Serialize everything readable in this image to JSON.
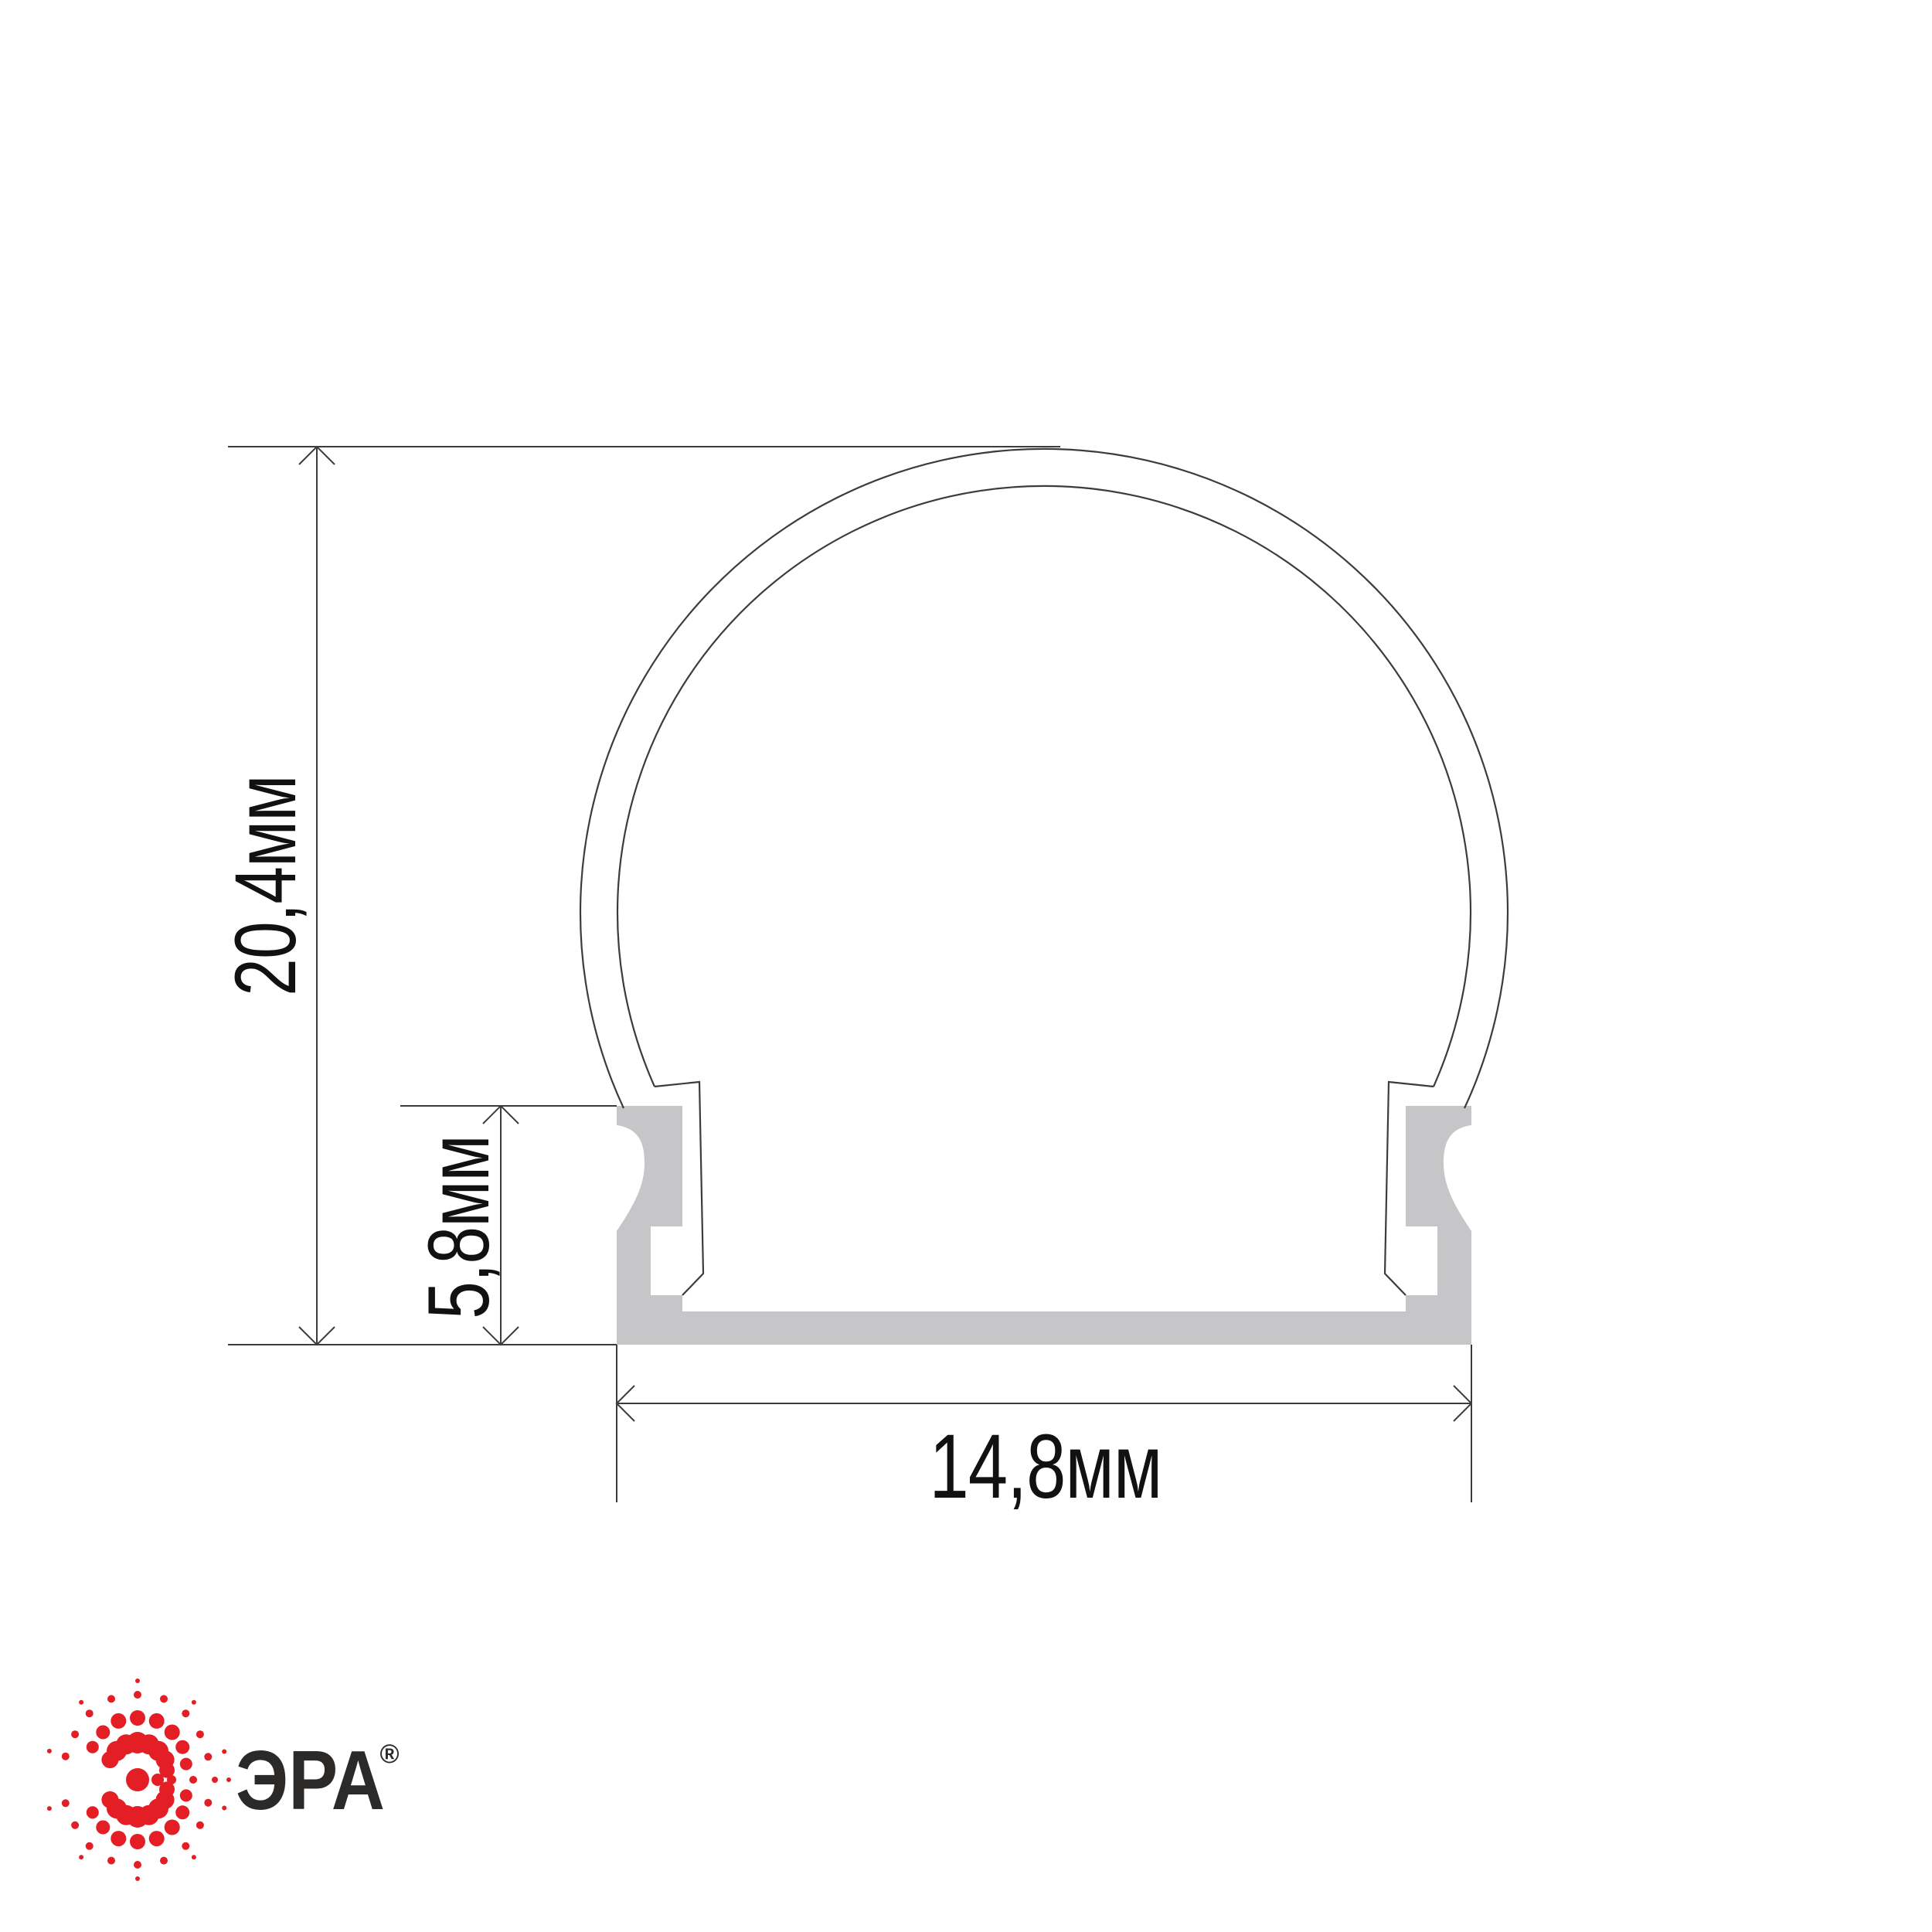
{
  "dimensions": {
    "height": "20,4мм",
    "base_height": "5,8мм",
    "width": "14,8мм"
  },
  "branding": {
    "name": "ЭРА",
    "registered_mark": "®"
  },
  "colors": {
    "background": "#ffffff",
    "profile_fill": "#c6c6c8",
    "line": "#3c3c3c",
    "text": "#111111",
    "brand_red": "#e31e24",
    "brand_text": "#2b2a29"
  }
}
